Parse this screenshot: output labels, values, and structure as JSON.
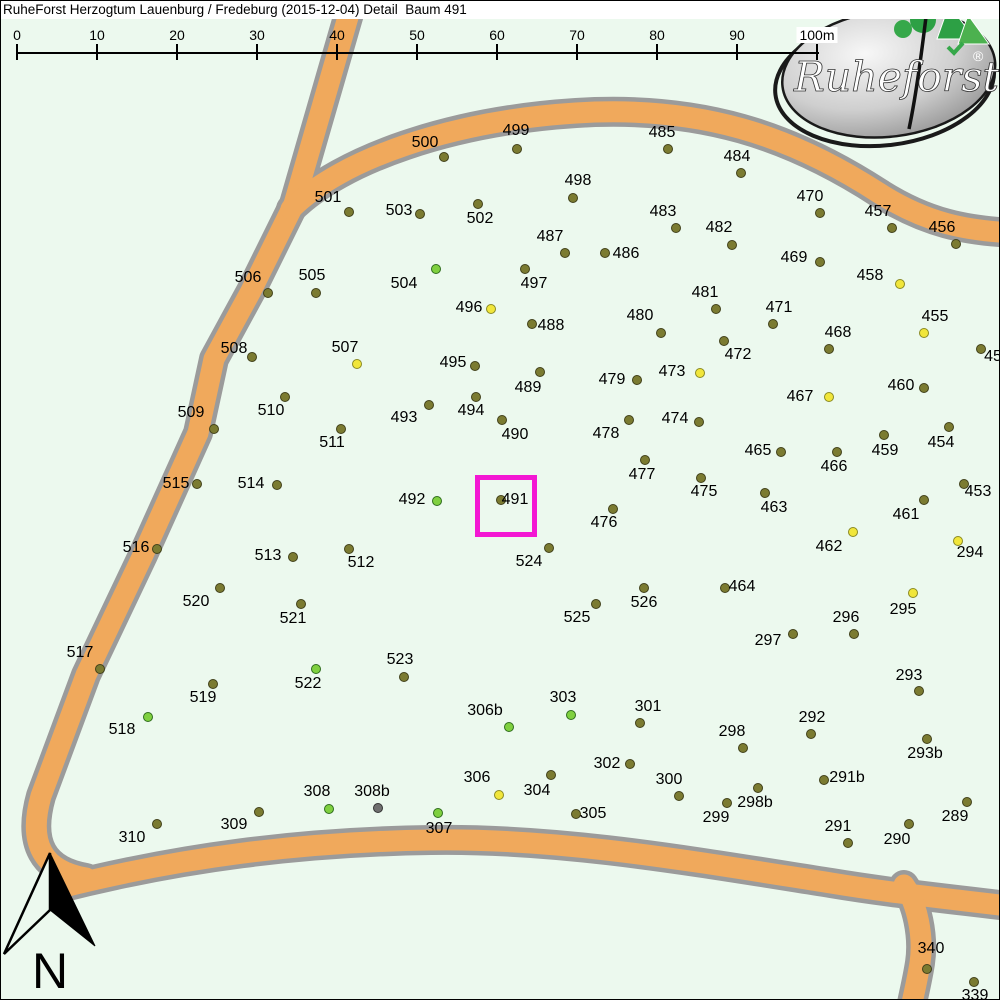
{
  "title": "RuheForst Herzogtum Lauenburg / Fredeburg (2015-12-04) Detail  Baum 491",
  "logo": {
    "brand": "Ruheforst",
    "registered": "®"
  },
  "compass": {
    "label": "N"
  },
  "highlight": {
    "tree": "491",
    "x": 474,
    "y": 474,
    "size": 52,
    "border": 5,
    "color": "#f318d3"
  },
  "colors": {
    "background": "#ecf9ee",
    "road_fill": "#f0a95c",
    "road_casing": "#9b9b9b",
    "highlight": "#f318d3",
    "dot_fill": {
      "o": "#7b7b31",
      "y": "#f1e63b",
      "g": "#7fd03f",
      "x": "#6f6f6f"
    },
    "dot_outline": {
      "o": "#41411a",
      "y": "#8a8a22",
      "g": "#2f6d1d",
      "x": "#333333"
    }
  },
  "ruler": {
    "labels": [
      "0",
      "10",
      "20",
      "30",
      "40",
      "50",
      "60",
      "70",
      "80",
      "90",
      "100m"
    ],
    "start_x": 16,
    "step_px": 80,
    "line_y": 51,
    "tick_top": 43,
    "label_top": 26
  },
  "trees": [
    [
      "500",
      443,
      156,
      "o",
      424,
      142
    ],
    [
      "499",
      516,
      148,
      "o",
      515,
      130
    ],
    [
      "501",
      348,
      211,
      "o",
      327,
      197
    ],
    [
      "503",
      419,
      213,
      "o",
      398,
      210
    ],
    [
      "502",
      477,
      203,
      "o",
      479,
      218
    ],
    [
      "498",
      572,
      197,
      "o",
      577,
      180
    ],
    [
      "485",
      667,
      148,
      "o",
      661,
      132
    ],
    [
      "484",
      740,
      172,
      "o",
      736,
      156
    ],
    [
      "470",
      819,
      212,
      "o",
      809,
      196
    ],
    [
      "457",
      891,
      227,
      "o",
      877,
      211
    ],
    [
      "456",
      955,
      243,
      "o",
      941,
      227
    ],
    [
      "487",
      564,
      252,
      "o",
      549,
      236
    ],
    [
      "486",
      604,
      252,
      "o",
      625,
      253
    ],
    [
      "497",
      524,
      268,
      "o",
      533,
      283
    ],
    [
      "483",
      675,
      227,
      "o",
      662,
      211
    ],
    [
      "482",
      731,
      244,
      "o",
      718,
      227
    ],
    [
      "469",
      819,
      261,
      "o",
      793,
      257
    ],
    [
      "458",
      899,
      283,
      "y",
      869,
      275
    ],
    [
      "506",
      267,
      292,
      "o",
      247,
      277
    ],
    [
      "505",
      315,
      292,
      "o",
      311,
      275
    ],
    [
      "504",
      435,
      268,
      "g",
      403,
      283
    ],
    [
      "496",
      490,
      308,
      "y",
      468,
      307
    ],
    [
      "488",
      531,
      323,
      "o",
      550,
      325
    ],
    [
      "480",
      660,
      332,
      "o",
      639,
      315
    ],
    [
      "481",
      715,
      308,
      "o",
      704,
      292
    ],
    [
      "472",
      723,
      340,
      "o",
      737,
      354
    ],
    [
      "471",
      772,
      323,
      "o",
      778,
      307
    ],
    [
      "455",
      923,
      332,
      "y",
      934,
      316
    ],
    [
      "508",
      251,
      356,
      "o",
      233,
      348
    ],
    [
      "507",
      356,
      363,
      "y",
      344,
      347
    ],
    [
      "495",
      474,
      365,
      "o",
      452,
      362
    ],
    [
      "489",
      539,
      371,
      "o",
      527,
      387
    ],
    [
      "479",
      636,
      379,
      "o",
      611,
      379
    ],
    [
      "473",
      699,
      372,
      "y",
      671,
      371
    ],
    [
      "468",
      828,
      348,
      "o",
      837,
      332
    ],
    [
      "467",
      828,
      396,
      "y",
      799,
      396
    ],
    [
      "460",
      923,
      387,
      "o",
      900,
      385
    ],
    [
      "459",
      883,
      434,
      "o",
      884,
      450
    ],
    [
      "454",
      948,
      426,
      "o",
      940,
      442
    ],
    [
      "453",
      963,
      483,
      "o",
      977,
      491
    ],
    [
      "461",
      923,
      499,
      "o",
      905,
      514
    ],
    [
      "462",
      852,
      531,
      "y",
      828,
      546
    ],
    [
      "294",
      957,
      540,
      "y",
      969,
      552
    ],
    [
      "295",
      912,
      592,
      "y",
      902,
      609
    ],
    [
      "466",
      836,
      451,
      "o",
      833,
      466
    ],
    [
      "465",
      780,
      451,
      "o",
      757,
      450
    ],
    [
      "474",
      698,
      421,
      "o",
      674,
      418
    ],
    [
      "475",
      700,
      477,
      "o",
      703,
      491
    ],
    [
      "463",
      764,
      492,
      "o",
      773,
      507
    ],
    [
      "478",
      628,
      419,
      "o",
      605,
      433
    ],
    [
      "477",
      644,
      459,
      "o",
      641,
      474
    ],
    [
      "476",
      612,
      508,
      "o",
      603,
      522
    ],
    [
      "510",
      284,
      396,
      "o",
      270,
      410
    ],
    [
      "493",
      428,
      404,
      "o",
      403,
      417
    ],
    [
      "494",
      475,
      396,
      "o",
      470,
      410
    ],
    [
      "490",
      501,
      419,
      "o",
      514,
      434
    ],
    [
      "509",
      213,
      428,
      "o",
      190,
      412
    ],
    [
      "511",
      340,
      428,
      "o",
      331,
      442
    ],
    [
      "515",
      196,
      483,
      "o",
      175,
      483
    ],
    [
      "514",
      276,
      484,
      "o",
      250,
      483
    ],
    [
      "492",
      436,
      500,
      "g",
      411,
      499
    ],
    [
      "491",
      500,
      499,
      "o",
      514,
      499
    ],
    [
      "516",
      156,
      548,
      "o",
      135,
      547
    ],
    [
      "513",
      292,
      556,
      "o",
      267,
      555
    ],
    [
      "512",
      348,
      548,
      "o",
      360,
      562
    ],
    [
      "524",
      548,
      547,
      "o",
      528,
      561
    ],
    [
      "520",
      219,
      587,
      "o",
      195,
      601
    ],
    [
      "521",
      300,
      603,
      "o",
      292,
      618
    ],
    [
      "526",
      643,
      587,
      "o",
      643,
      602
    ],
    [
      "525",
      595,
      603,
      "o",
      576,
      617
    ],
    [
      "464",
      724,
      587,
      "o",
      741,
      586
    ],
    [
      "296",
      853,
      633,
      "o",
      845,
      617
    ],
    [
      "297",
      792,
      633,
      "o",
      767,
      640
    ],
    [
      "517",
      99,
      668,
      "o",
      79,
      652
    ],
    [
      "519",
      212,
      683,
      "o",
      202,
      697
    ],
    [
      "522",
      315,
      668,
      "g",
      307,
      683
    ],
    [
      "518",
      147,
      716,
      "g",
      121,
      729
    ],
    [
      "523",
      403,
      676,
      "o",
      399,
      659
    ],
    [
      "306b",
      508,
      726,
      "g",
      484,
      710
    ],
    [
      "303",
      570,
      714,
      "g",
      562,
      697
    ],
    [
      "301",
      639,
      722,
      "o",
      647,
      706
    ],
    [
      "302",
      629,
      763,
      "o",
      606,
      763
    ],
    [
      "300",
      678,
      795,
      "o",
      668,
      779
    ],
    [
      "306",
      498,
      794,
      "y",
      476,
      777
    ],
    [
      "304",
      550,
      774,
      "o",
      536,
      790
    ],
    [
      "305",
      575,
      813,
      "o",
      592,
      813
    ],
    [
      "308",
      328,
      808,
      "g",
      316,
      791
    ],
    [
      "308b",
      377,
      807,
      "x",
      371,
      791
    ],
    [
      "309",
      258,
      811,
      "o",
      233,
      824
    ],
    [
      "310",
      156,
      823,
      "o",
      131,
      837
    ],
    [
      "307",
      437,
      812,
      "g",
      438,
      828
    ],
    [
      "299",
      726,
      802,
      "o",
      715,
      817
    ],
    [
      "298b",
      757,
      787,
      "o",
      754,
      802
    ],
    [
      "291b",
      823,
      779,
      "o",
      846,
      777
    ],
    [
      "298",
      742,
      747,
      "o",
      731,
      731
    ],
    [
      "292",
      810,
      733,
      "o",
      811,
      717
    ],
    [
      "293",
      918,
      690,
      "o",
      908,
      675
    ],
    [
      "293b",
      926,
      738,
      "o",
      924,
      753
    ],
    [
      "291",
      847,
      842,
      "o",
      837,
      826
    ],
    [
      "290",
      908,
      823,
      "o",
      896,
      839
    ],
    [
      "289",
      966,
      801,
      "o",
      954,
      816
    ],
    [
      "340",
      926,
      968,
      "o",
      930,
      948
    ],
    [
      "339",
      973,
      981,
      "o",
      974,
      995
    ],
    [
      "45",
      980,
      348,
      "o",
      992,
      356
    ]
  ]
}
